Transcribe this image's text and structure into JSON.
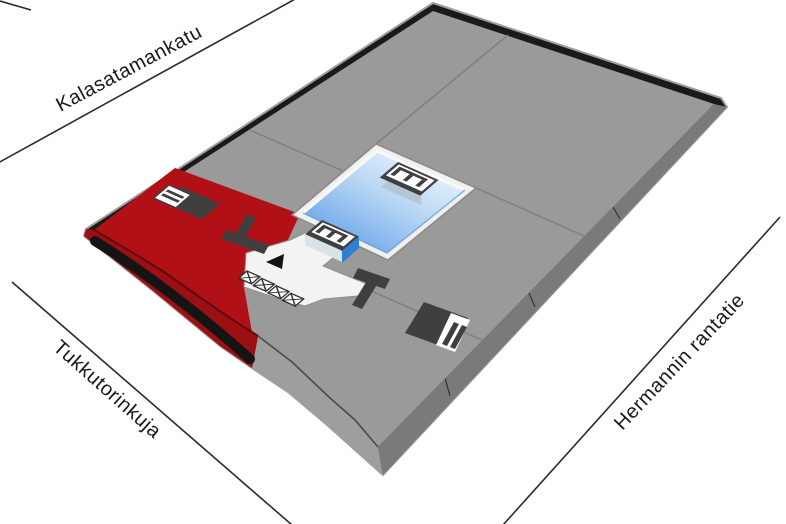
{
  "diagram": {
    "type": "axonometric-rooftop-site-plan",
    "streets": {
      "top_left": {
        "label": "Kalasatamankatu"
      },
      "bottom_left": {
        "label": "Tukkutorinkuja"
      },
      "bottom_right": {
        "label": "Hermannin rantatie"
      }
    },
    "icons": {
      "direction_arrow": "black-left-triangle",
      "escalator_hatch": "x-crosshatch-strip",
      "stair_entrance_glyph": "white-panel-with-dark-bars"
    },
    "colors": {
      "background": "#ffffff",
      "label_text": "#1a1a1a",
      "street_line": "#2a2a2a",
      "slab_edge": "#1a1a1a",
      "slab_top": "#9a9a9a",
      "slab_side_right": "#7a7a7a",
      "slab_side_bottom": "#9e9e9e",
      "seam": "#7f7f7f",
      "red_area_top": "#b11116",
      "red_area_side": "#9c1014",
      "walkway": "#f4f3f1",
      "pool_rim": "#f1f0ed",
      "water_light": "#f2f9fe",
      "water_mid": "#b9d7f4",
      "water_deep": "#5e9de7",
      "structure_dark": "#3f3f3f",
      "structure_blue": "#2f7fd6",
      "structure_side": "#b5c6d2",
      "structure_side_pale": "#d8e2e9"
    }
  }
}
